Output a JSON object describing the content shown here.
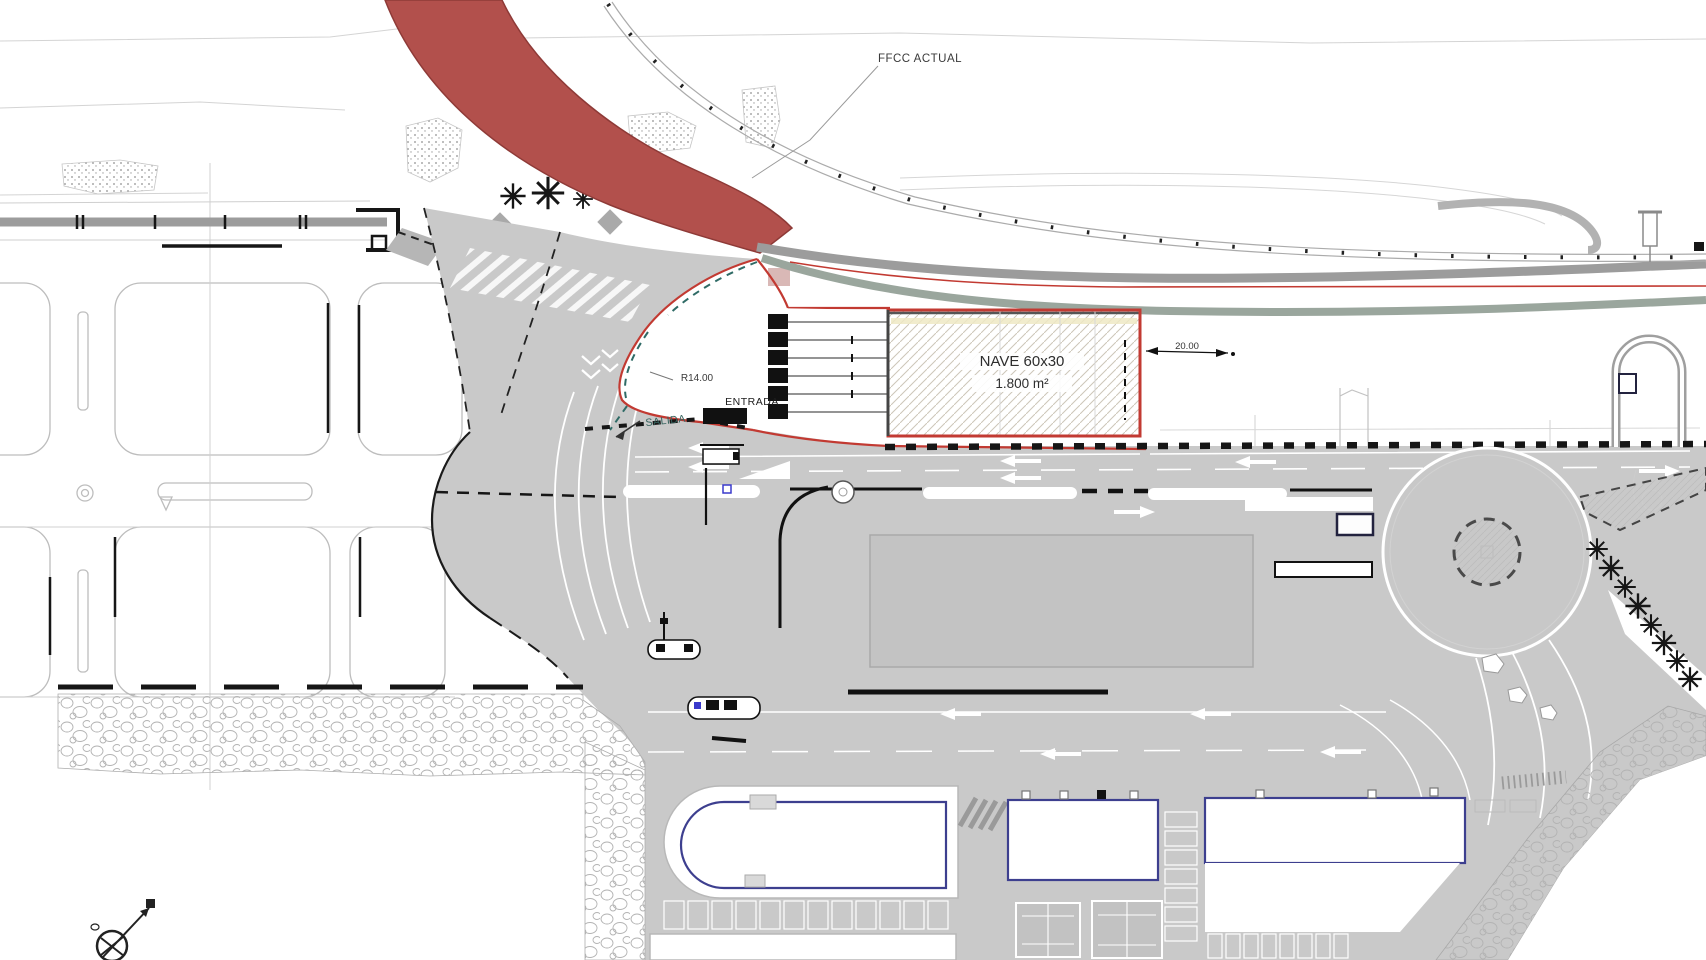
{
  "plan": {
    "annotations": {
      "railway": "FFCC ACTUAL",
      "building_name": "NAVE 60x30",
      "building_area": "1.800 m²",
      "radius_dim": "R14.00",
      "entrance": "ENTRADA",
      "exit": "SALIDA",
      "width_dim": "20.00"
    },
    "colors": {
      "background": "#ffffff",
      "highlight_band_red": "#b2504c",
      "boundary_red": "#c23a32",
      "pavement_gray": "#c9c9c9",
      "inner_pad_gray": "#c3c3c3",
      "road_band_gray": "#9c9c9c",
      "road_band_green_gray": "#9aa69d",
      "line_black": "#161616",
      "exit_label_teal": "#35635e",
      "building_outline_blue": "#3d3f8f",
      "marker_blue": "#3a3acc",
      "stone_outline": "#b3b3b3",
      "hatch_tan": "#cdc6b8"
    }
  }
}
